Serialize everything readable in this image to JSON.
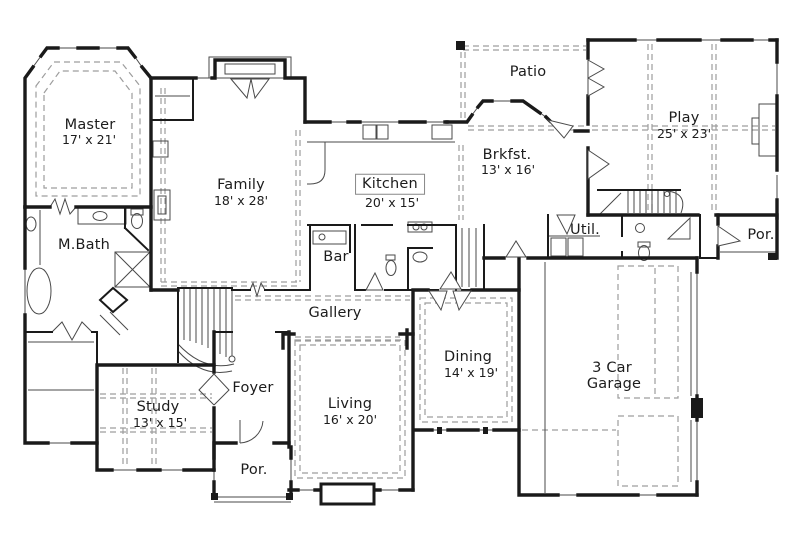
{
  "colors": {
    "wall": "#1a1a1a",
    "thin": "#4a4a4a",
    "dash": "#9d9d9d",
    "text": "#1c1c1c",
    "bg": "#ffffff"
  },
  "rooms": {
    "master": {
      "label": "Master",
      "dims": "17' x 21'"
    },
    "mbath": {
      "label": "M.Bath"
    },
    "family": {
      "label": "Family",
      "dims": "18' x 28'"
    },
    "kitchen": {
      "label": "Kitchen",
      "dims": "20' x 15'"
    },
    "bar": {
      "label": "Bar"
    },
    "patio": {
      "label": "Patio"
    },
    "brkfst": {
      "label": "Brkfst.",
      "dims": "13' x 16'"
    },
    "play": {
      "label": "Play",
      "dims": "25' x 23'"
    },
    "util": {
      "label": "Util."
    },
    "porch_right": {
      "label": "Por."
    },
    "gallery": {
      "label": "Gallery"
    },
    "foyer": {
      "label": "Foyer"
    },
    "study": {
      "label": "Study",
      "dims": "13' x 15'"
    },
    "living": {
      "label": "Living",
      "dims": "16' x 20'"
    },
    "porch_front": {
      "label": "Por."
    },
    "dining": {
      "label": "Dining",
      "dims": "14' x 19'"
    },
    "garage": {
      "label_line1": "3 Car",
      "label_line2": "Garage"
    }
  }
}
